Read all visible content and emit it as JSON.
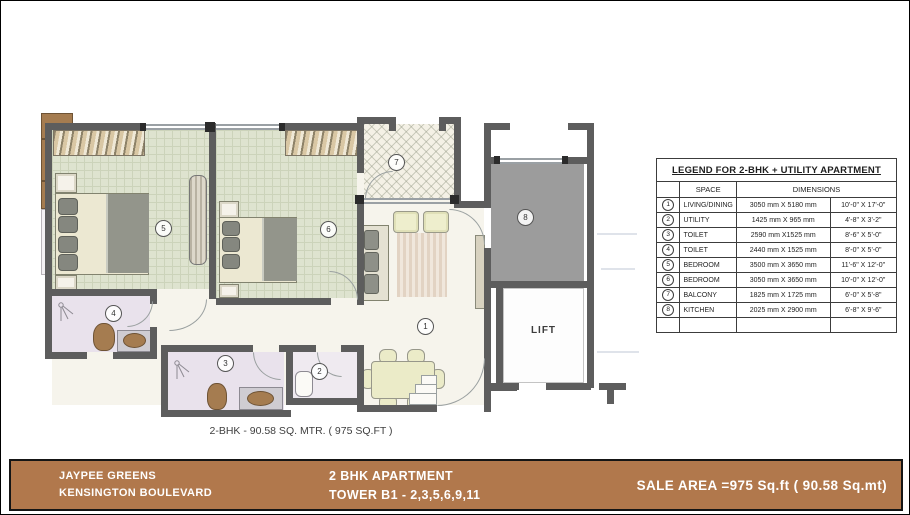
{
  "plan": {
    "caption": "2-BHK  - 90.58 SQ. MTR. ( 975 SQ.FT )",
    "lift_label": "LIFT",
    "rooms": [
      {
        "no": "1",
        "name": "living-dining"
      },
      {
        "no": "2",
        "name": "utility"
      },
      {
        "no": "3",
        "name": "toilet"
      },
      {
        "no": "4",
        "name": "toilet"
      },
      {
        "no": "5",
        "name": "bedroom"
      },
      {
        "no": "6",
        "name": "bedroom"
      },
      {
        "no": "7",
        "name": "balcony"
      },
      {
        "no": "8",
        "name": "kitchen"
      }
    ]
  },
  "legend": {
    "title": "LEGEND FOR 2-BHK + UTILITY APARTMENT",
    "headers": {
      "space": "SPACE",
      "dimensions": "DIMENSIONS"
    },
    "rows": [
      {
        "no": "1",
        "space": "LIVING/DINING",
        "mm": "3050 mm X 5180 mm",
        "ft": "10'-0\" X 17'-0\""
      },
      {
        "no": "2",
        "space": "UTILITY",
        "mm": "1425 mm X 965  mm",
        "ft": "4'-8\" X 3'-2\""
      },
      {
        "no": "3",
        "space": "TOILET",
        "mm": "2590 mm X1525  mm",
        "ft": "8'-6\" X 5'-0\""
      },
      {
        "no": "4",
        "space": "TOILET",
        "mm": "2440 mm X 1525 mm",
        "ft": "8'-0\" X 5'-0\""
      },
      {
        "no": "5",
        "space": "BEDROOM",
        "mm": "3500 mm X 3650 mm",
        "ft": "11'-6\" X 12'-0\""
      },
      {
        "no": "6",
        "space": "BEDROOM",
        "mm": "3050 mm X 3650 mm",
        "ft": "10'-0\" X 12'-0\""
      },
      {
        "no": "7",
        "space": "BALCONY",
        "mm": "1825 mm X 1725 mm",
        "ft": "6'-0\" X 5'-8\""
      },
      {
        "no": "8",
        "space": "KITCHEN",
        "mm": "2025 mm X 2900 mm",
        "ft": "6'-8\" X 9'-6\""
      }
    ]
  },
  "footer": {
    "project_line1": "JAYPEE GREENS",
    "project_line2": "KENSINGTON BOULEVARD",
    "unit_line1": "2 BHK APARTMENT",
    "unit_line2": "TOWER B1 - 2,3,5,6,9,11",
    "sale_area": "SALE AREA =975 Sq.ft ( 90.58 Sq.mt)"
  },
  "colors": {
    "footer_bar": "#b1784c",
    "wall": "#5d5d5d",
    "bedroom_floor": "#dee3cf",
    "toilet_floor": "#e9e2ec",
    "living_floor": "#f6f4ec",
    "balcony_floor": "#f4f1e6",
    "kitchen_floor": "#9c9c9c",
    "furniture_brown": "#a57c50",
    "blanket_gray": "#93958b"
  }
}
